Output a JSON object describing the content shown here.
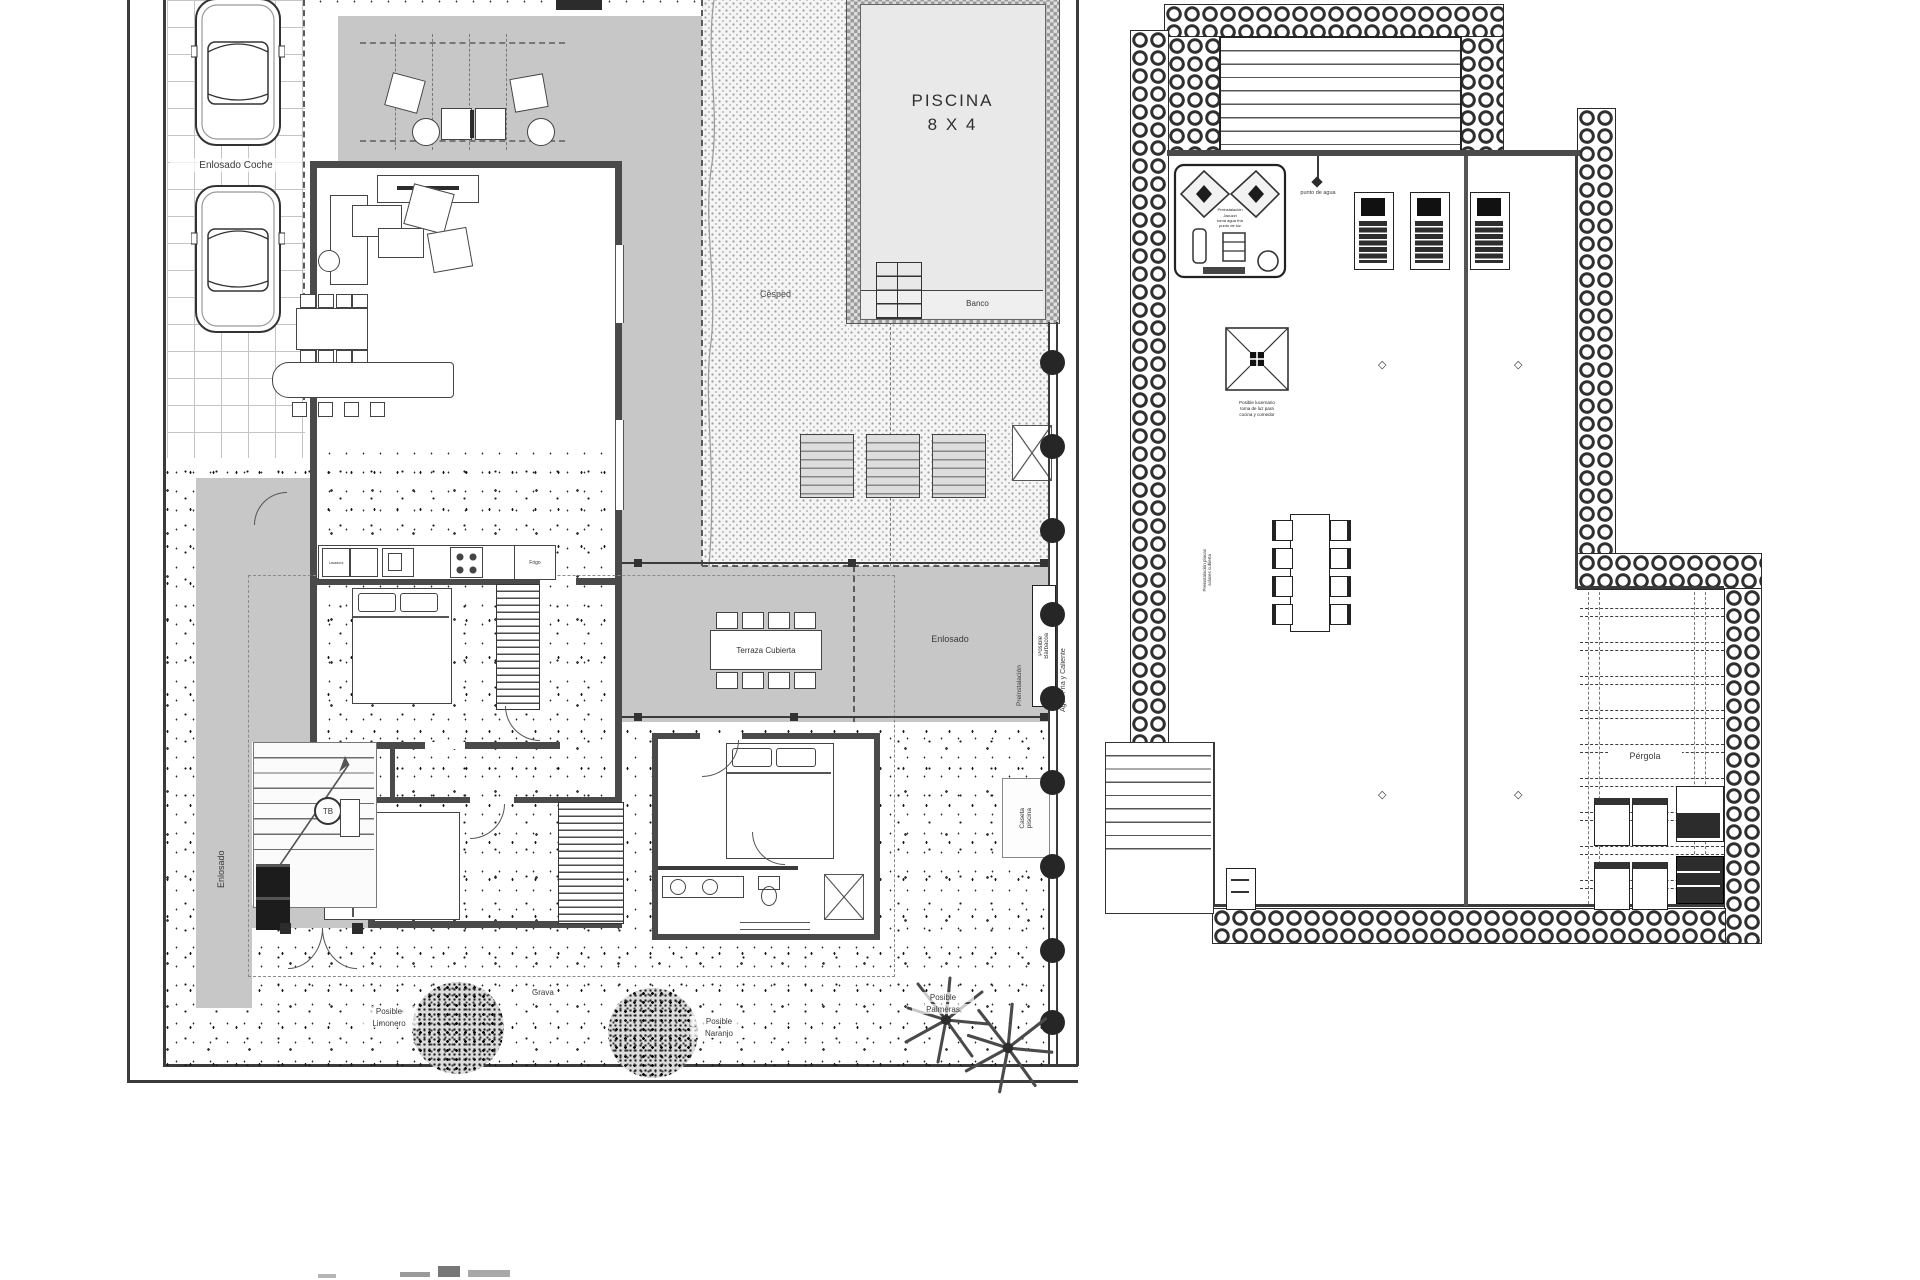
{
  "colors": {
    "wall": "#4a4a4a",
    "paving": "#c7c7c7",
    "pool_water": "#e9e9e9",
    "line": "#333333"
  },
  "left_plan": {
    "pool": {
      "title_line1": "PISCINA",
      "title_line2": "8 X 4",
      "bench": "Banco"
    },
    "areas": {
      "driveway": "Enlosado Coche",
      "lawn": "Césped",
      "covered_terrace": "Terraza Cubierta",
      "paved_terrace": "Enlosado",
      "paved_side": "Enlosado",
      "gravel": "Grava"
    },
    "annotations": {
      "preinstall": "Preinstalación",
      "bbq": [
        "Posible",
        "Barbacoa"
      ],
      "water": "Agua Fría y Caliente",
      "shed": [
        "Caseta",
        "piscina"
      ],
      "palms": [
        "Posible",
        "Palmeras"
      ],
      "lemon": [
        "Posible",
        "Limonero"
      ],
      "orange": [
        "Posible",
        "Naranjo"
      ],
      "tb": "TB",
      "fridge": "Frigo",
      "washer": "Lavadora"
    }
  },
  "right_plan": {
    "annotations": {
      "water_point": "punto de agua",
      "pergola": "Pérgola",
      "spa": [
        "Preinstalación",
        "Jacuzzi",
        "toma agua fría",
        "punto de luz"
      ],
      "skylight": [
        "Posible lucernario",
        "toma de luz para",
        "cocina y comedor"
      ],
      "solar": [
        "Preinstalación placas",
        "solares cubierta"
      ]
    }
  }
}
